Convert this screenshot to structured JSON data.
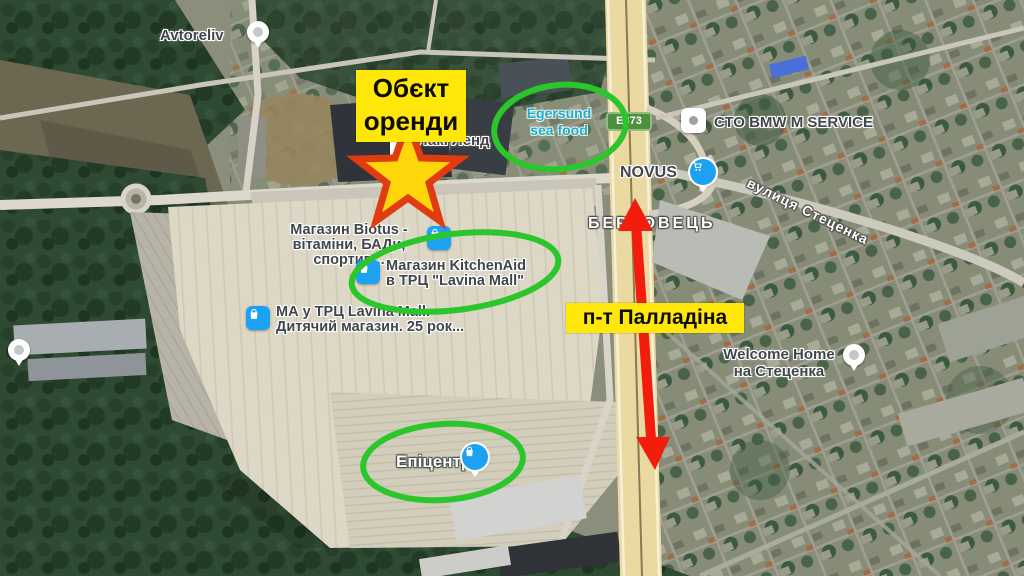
{
  "annotations": {
    "rent_object_label": "Обєкт оренди",
    "avenue_label": "п-т Палладіна",
    "colors": {
      "highlight_yellow": "#FFE70A",
      "circle_green": "#2BC62B",
      "arrow_red": "#F21D0C",
      "star_fill": "#FFD60A",
      "star_stroke": "#E03C10"
    }
  },
  "map_labels": {
    "avtoreliv": "Avtoreliv",
    "laki_lend": "Лакі Ленд",
    "egersund_line1": "Egersund",
    "egersund_line2": "sea food",
    "road_badge": "E373",
    "sto_bmw": "СТО BMW M SERVICE",
    "novus": "NOVUS",
    "street_stetsenka": "вулиця Стеценка",
    "district": "БЕРКОВЕЦЬ",
    "biotus_line1": "Магазин Biotus -",
    "biotus_line2": "вітаміни, БАДи, спортив...",
    "kitchenaid_line1": "Магазин KitchenAid",
    "kitchenaid_line2": "в ТРЦ \"Lavina Mall\"",
    "ma_line1": "МА у ТРЦ Lavina Mall.",
    "ma_line2": "Дитячий магазин. 25 рок...",
    "welcome_line1": "Welcome Home",
    "welcome_line2": "на Стеценка",
    "epicentr": "Епіцентр"
  }
}
